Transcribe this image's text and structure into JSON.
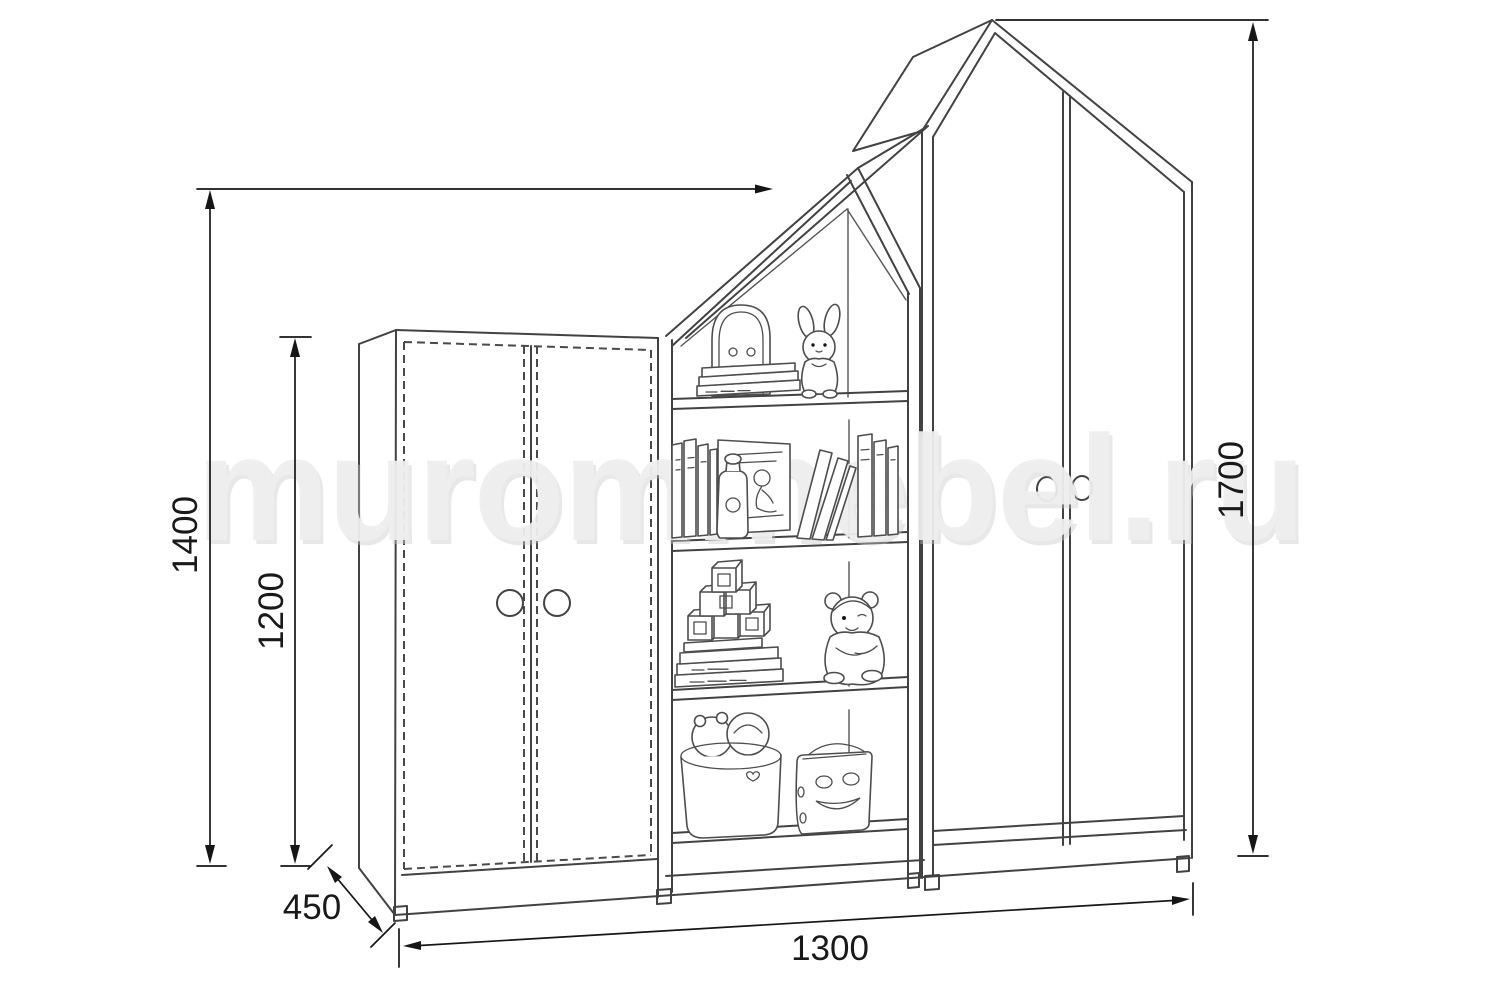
{
  "watermark": {
    "text": "murommebel.ru"
  },
  "dimensions": {
    "middle_peak_height": "1400",
    "left_wardrobe_height": "1200",
    "depth": "450",
    "total_width": "1300",
    "right_wardrobe_height": "1700"
  }
}
